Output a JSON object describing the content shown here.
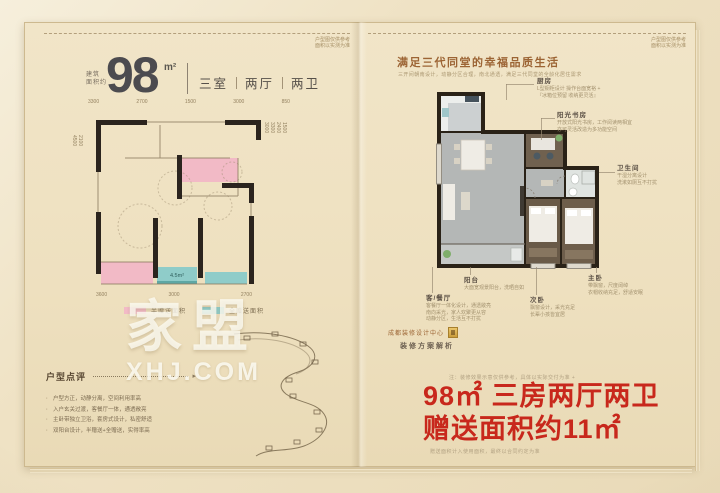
{
  "brand": {
    "watermark_text": "家盟",
    "watermark_domain": "XHJ.COM"
  },
  "colors": {
    "accent_pink": "#f2bac6",
    "accent_teal": "#8fccc9",
    "promo_red": "#c8281c",
    "title_brown": "#9c6434",
    "wall_black": "#2b241e"
  },
  "left_page": {
    "page_note_line1": "户型图仅供参考",
    "page_note_line2": "面积以实测为准",
    "area_prefix_line1": "建筑",
    "area_prefix_line2": "面积约",
    "area_value": "98",
    "area_unit": "m²",
    "rooms_spec": [
      "三室",
      "两厅",
      "两卫"
    ],
    "dims_top": [
      "3300",
      "2700",
      "1500",
      "3000",
      "850"
    ],
    "dims_bottom": [
      "3600",
      "3000",
      "2700"
    ],
    "dims_left": [
      "2100",
      "4500"
    ],
    "dims_right": [
      "1500",
      "2400",
      "3300",
      "3000"
    ],
    "inner_area_label": "4.5m²",
    "legend": [
      {
        "label": "半赠送面积",
        "color": "#f2bac6"
      },
      {
        "label": "全赠送面积",
        "color": "#8fccc9"
      }
    ],
    "review": {
      "title": "户型点评",
      "points": [
        "户型方正，动静分离，空间利用率高",
        "入户玄关过渡，客餐厅一体，通透敞亮",
        "主卧带独立卫浴，套房式设计，私密舒适",
        "双阳台设计，半赠送+全赠送，实得率高"
      ]
    }
  },
  "right_page": {
    "page_note_line1": "户型图仅供参考",
    "page_note_line2": "面积以实测为准",
    "title": "满足三代同堂的幸福品质生活",
    "subtitle": "三开间朝南设计，动静分区合理，南北通透，满足三代同堂的全龄化居住需求",
    "callouts": {
      "kitchen": {
        "name": "厨房",
        "line1": "L型橱柜设计 操作台面宽裕 +",
        "line2": "『冰箱位预留 收纳更灵活』"
      },
      "study": {
        "name": "阳光书房",
        "line1": "开放式阳光书房，工作阅读两相宜",
        "line2": "亦可灵活改造为多功能空间"
      },
      "bath": {
        "name": "卫生间",
        "line1": "干湿分离设计",
        "line2": "洗漱如厕互不打扰"
      },
      "balcony": {
        "name": "阳台",
        "line1": "大面宽观景阳台，洗晒自如"
      },
      "master": {
        "name": "主卧",
        "line1": "带飘窗，尺度阔绰",
        "line2": "衣帽收纳充足，舒适安眠"
      },
      "living": {
        "name": "客/餐厅",
        "line1": "客餐厅一体化设计，通透敞亮",
        "line2": "南向采光，家人欢聚更从容",
        "line3": "动静分区，生活互不打扰"
      },
      "second": {
        "name": "次卧",
        "line1": "飘窗设计，采光充足",
        "line2": "长辈小孩皆宜居"
      }
    },
    "seal_text": "成都装修设计中心",
    "plan_link_text": "装修方案解析",
    "note_above_promo": "注：装修效果示意仅供参考，具体以实际交付为准 +",
    "promo_line1": "98㎡ 三房两厅两卫",
    "promo_line2": "赠送面积约11㎡",
    "footnote": "赠送面积计入使用面积，最终以合同约定为准"
  }
}
